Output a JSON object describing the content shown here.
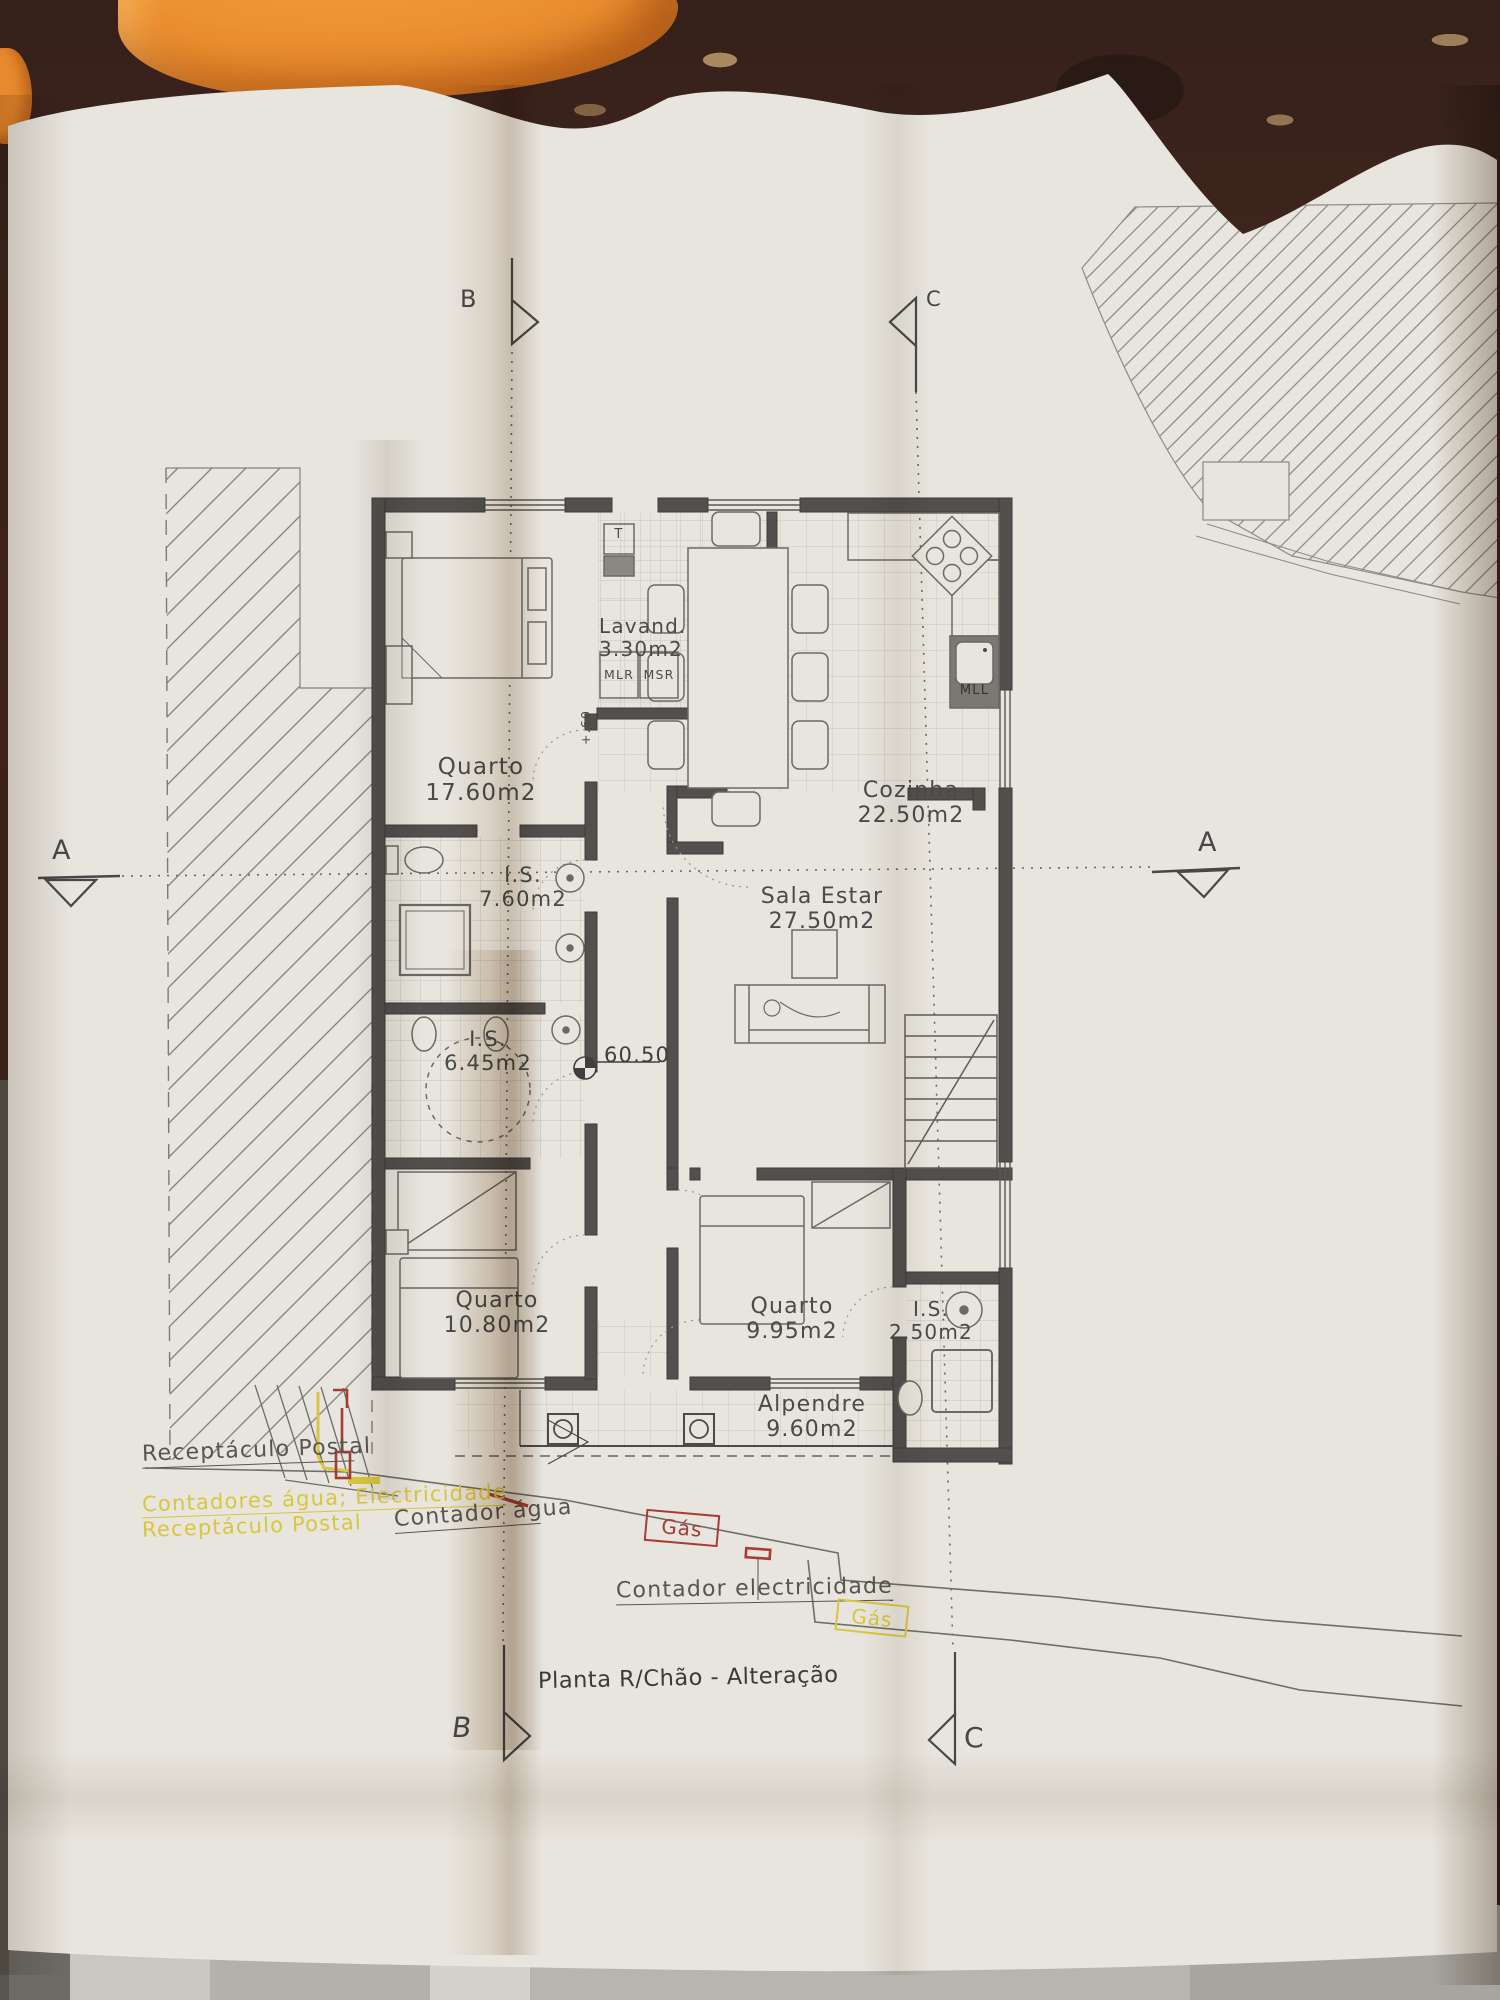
{
  "photo": {
    "title": "Planta R/Chão - Alteração"
  },
  "rooms": {
    "quarto_grande": {
      "name": "Quarto",
      "area": "17.60m2"
    },
    "lavandaria": {
      "name": "Lavand.",
      "area": "3.30m2"
    },
    "cozinha": {
      "name": "Cozinha",
      "area": "22.50m2"
    },
    "is_760": {
      "name": "I.S.",
      "area": "7.60m2"
    },
    "sala_estar": {
      "name": "Sala Estar",
      "area": "27.50m2"
    },
    "is_645": {
      "name": "I.S.",
      "area": "6.45m2"
    },
    "quarto_1080": {
      "name": "Quarto",
      "area": "10.80m2"
    },
    "quarto_995": {
      "name": "Quarto",
      "area": "9.95m2"
    },
    "is_250": {
      "name": "I.S.",
      "area": "2.50m2"
    },
    "alpendre": {
      "name": "Alpendre",
      "area": "9.60m2"
    }
  },
  "equipment": {
    "t": "T",
    "mlr": "MLR",
    "msr": "MSR",
    "mll": "MLL",
    "level_mark": "60.50",
    "step_level": "+.60"
  },
  "annotations": {
    "receptaculo_postal": "Receptáculo Postal",
    "contadores": "Contadores água; Electricidade",
    "receptaculo_postal_2": "Receptáculo Postal",
    "contador_agua": "Contador água",
    "gas_1": "Gás",
    "contador_electricidade": "Contador electricidade",
    "gas_2": "Gás"
  },
  "section_markers": {
    "top_b": "B",
    "top_c": "C",
    "left_a": "A",
    "right_a": "A",
    "bottom_b": "B",
    "bottom_c": "C"
  },
  "colors": {
    "annotation_yellow": "#d8c63e",
    "annotation_red": "#a93a36",
    "ink": "#4a4a4a",
    "paper": "#e8e5de"
  }
}
